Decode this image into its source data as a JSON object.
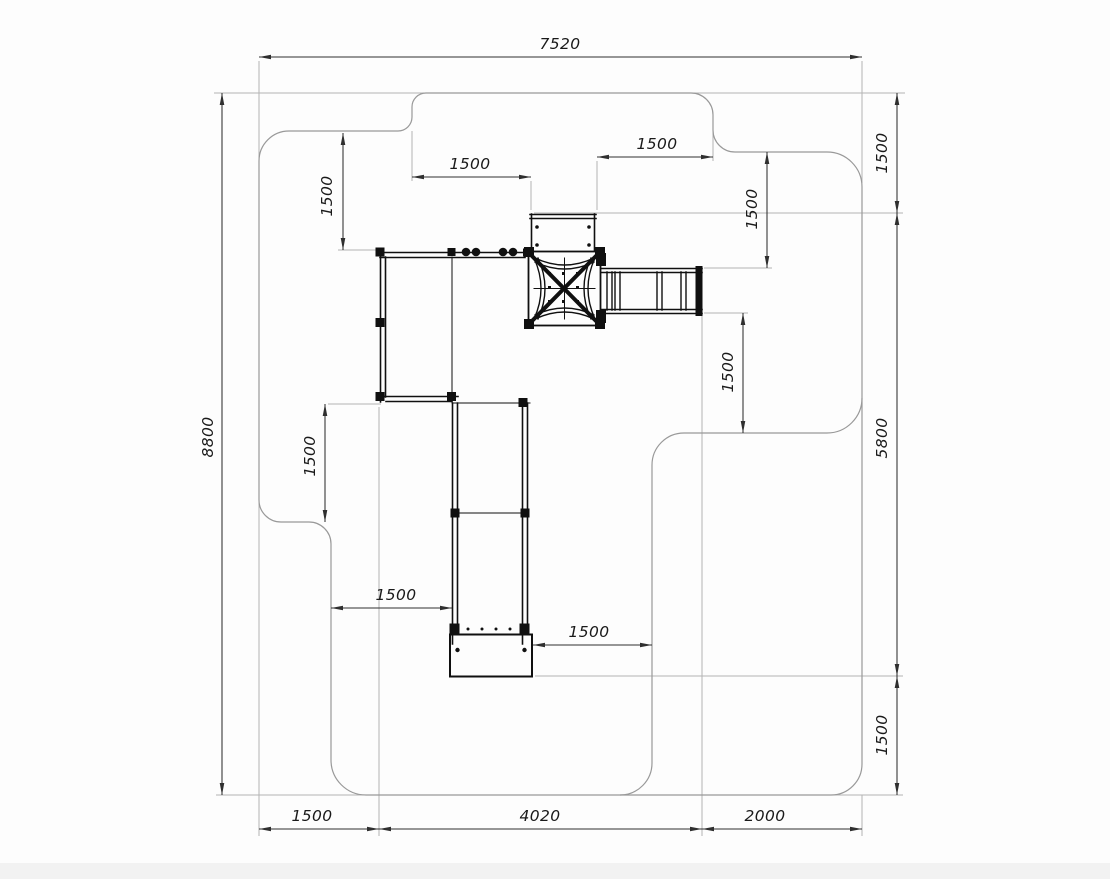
{
  "drawing": {
    "title": "Playground equipment plan view with safety zone dimensions",
    "units": "mm",
    "labels": {
      "overall_width": "7520",
      "overall_height": "8800",
      "clearance_top_left": "1500",
      "clearance_top_right": "1500",
      "clearance_left_top": "1500",
      "clearance_right_upper": "1500",
      "right_segment_top": "1500",
      "right_segment_middle": "5800",
      "right_segment_bottom": "1500",
      "clearance_right_mid": "1500",
      "clearance_left_mid": "1500",
      "clearance_left_lower": "1500",
      "clearance_bottom_mid": "1500",
      "bottom_segment_left": "1500",
      "bottom_segment_center": "4020",
      "bottom_segment_right": "2000"
    },
    "colors": {
      "background": "#fdfdfd",
      "equipment_line": "#101010",
      "safety_zone_outline": "#999999",
      "extension_line": "#b3b3b3",
      "dimension_line": "#2f2f2f",
      "label_text": "#1a1a1a"
    }
  }
}
